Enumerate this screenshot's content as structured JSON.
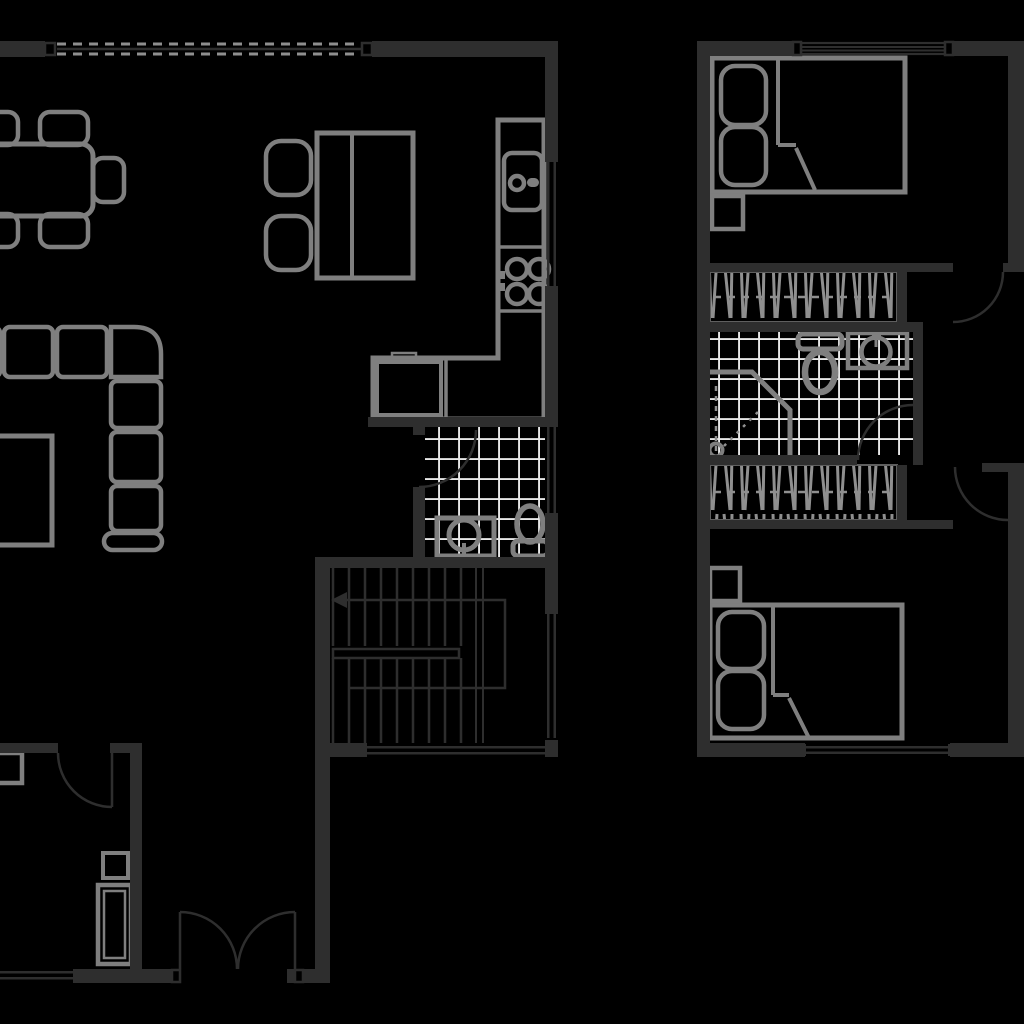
{
  "canvas": {
    "width": 1024,
    "height": 1024,
    "background": "#000000"
  },
  "palette": {
    "wall": "#2e2e2e",
    "furniture": "#7f7f7f",
    "tile_grid": "#e8e8e8",
    "closet_hatch": "#8f8f8f",
    "closet_outline": "#5f5f5f",
    "annotation": "#2e2e2e"
  },
  "image_type": "architectural-floor-plan",
  "plans": [
    {
      "name": "lower-floor",
      "areas": [
        {
          "name": "living-dining-area",
          "items": [
            "dining-table",
            "dining-chairs",
            "side-table-two-seats",
            "sectional-sofa",
            "coffee-table"
          ]
        },
        {
          "name": "kitchen",
          "items": [
            "l-shaped-counter",
            "kitchen-sink",
            "cooktop-four-burners",
            "built-in-appliance"
          ]
        },
        {
          "name": "bathroom",
          "floor": "tiled",
          "items": [
            "washbasin",
            "toilet"
          ]
        },
        {
          "name": "staircase",
          "items": [
            "upper-flight-treads",
            "lower-flight-treads",
            "handrail",
            "direction-arrow"
          ]
        },
        {
          "name": "entry-hall",
          "items": [
            "double-entry-door"
          ]
        },
        {
          "name": "storage-room",
          "items": [
            "corner-cabinet",
            "small-cabinet",
            "tall-cabinet"
          ]
        }
      ],
      "openings": [
        "folding-glass-wall-top",
        "kitchen-window",
        "bathroom-window",
        "stair-window",
        "rear-window-bottom",
        "entry-window",
        "storage-room-door",
        "bathroom-door",
        "double-entry-door"
      ]
    },
    {
      "name": "upper-floor",
      "areas": [
        {
          "name": "bedroom-top",
          "items": [
            "double-bed",
            "two-pillows",
            "blanket-fold",
            "nightstand"
          ]
        },
        {
          "name": "closet-top",
          "type": "wardrobe-hanging-rail"
        },
        {
          "name": "bathroom",
          "floor": "tiled",
          "items": [
            "corner-shower",
            "toilet",
            "washbasin"
          ]
        },
        {
          "name": "closet-bottom",
          "type": "wardrobe-hanging-rail"
        },
        {
          "name": "bedroom-bottom",
          "items": [
            "double-bed",
            "two-pillows",
            "blanket-fold",
            "nightstand"
          ]
        },
        {
          "name": "hallway",
          "items": [
            "door-to-bedroom-top",
            "door-to-bathroom",
            "door-to-bedroom-bottom"
          ]
        }
      ],
      "openings": [
        "bedroom-top-window",
        "bedroom-bottom-window"
      ]
    }
  ]
}
